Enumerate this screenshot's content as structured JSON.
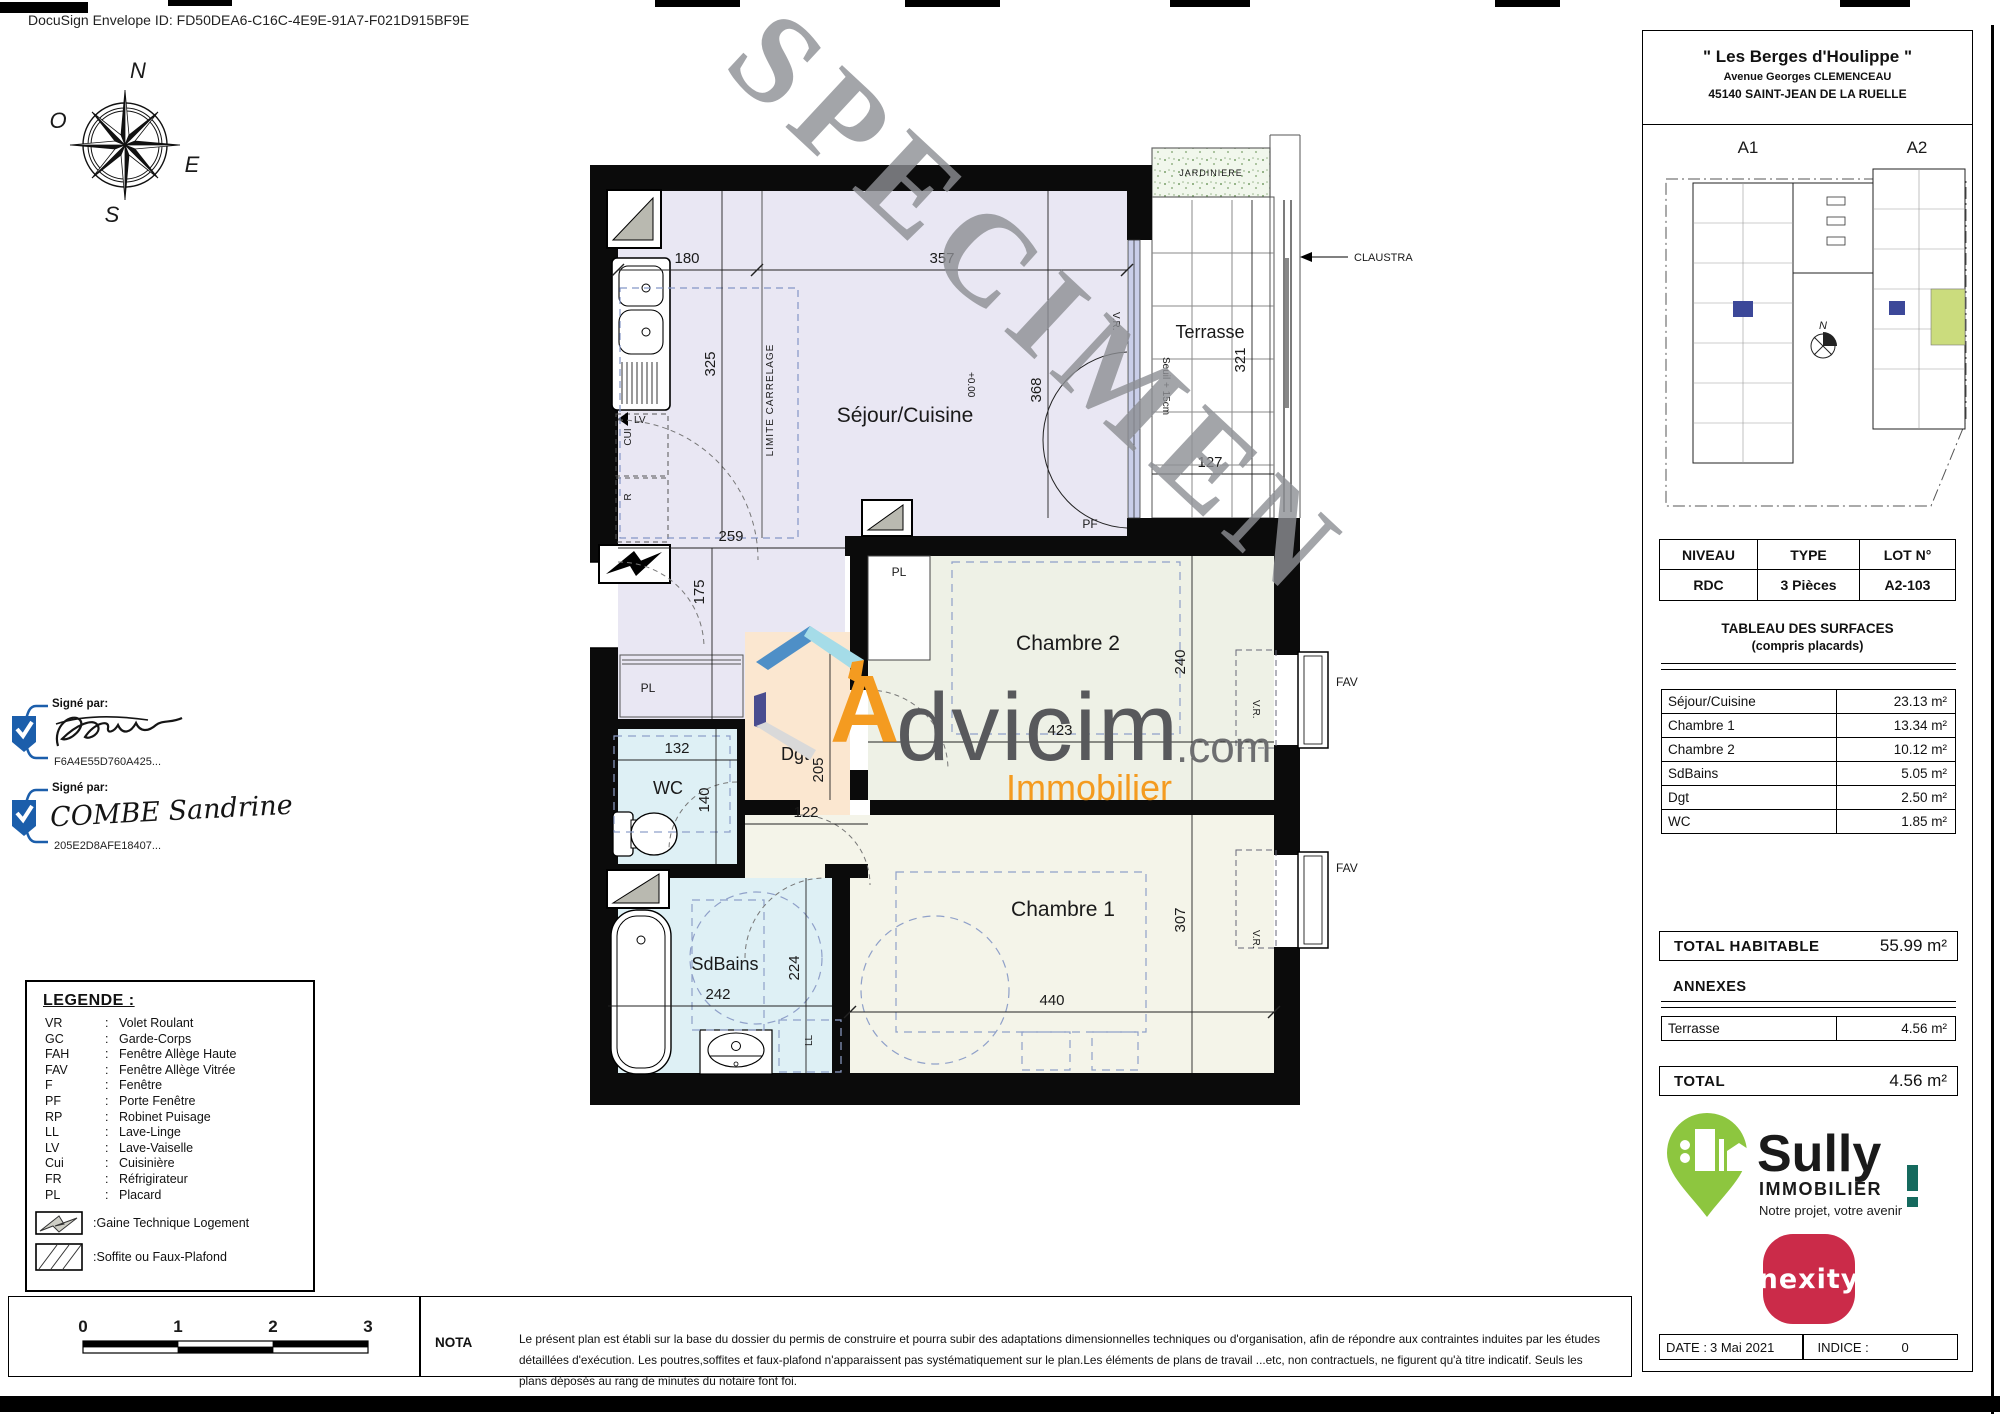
{
  "docusign": {
    "envelope": "DocuSign Envelope ID: FD50DEA6-C16C-4E9E-91A7-F021D915BF9E"
  },
  "watermark": "SPECIMEN",
  "compass": {
    "n": "N",
    "o": "O",
    "e": "E",
    "s": "S"
  },
  "advicim": {
    "initial": "A",
    "name": "dvicim",
    "tld": ".com",
    "tagline": "Immobilier"
  },
  "signatures": {
    "sig1": {
      "label": "Signé par:",
      "id": "F6A4E55D760A425..."
    },
    "sig2": {
      "label": "Signé par:",
      "name": "COMBE Sandrine",
      "id": "205E2D8AFE18407..."
    }
  },
  "plan": {
    "rooms": {
      "sejour": "Séjour/Cuisine",
      "chambre2": "Chambre 2",
      "chambre1": "Chambre 1",
      "sdbains": "SdBains",
      "wc": "WC",
      "dgt": "Dgt",
      "terrasse": "Terrasse"
    },
    "annotations": {
      "pl": "PL",
      "pf": "PF",
      "fav": "FAV",
      "vr": "V.R.",
      "claustra": "CLAUSTRA",
      "jardiniere": "JARDINIERE",
      "limite_carrelage": "LIMITE CARRELAGE",
      "cui": "CUI",
      "fridge": "R",
      "lv": "LV",
      "ll": "LL",
      "level": "+0.00",
      "seuil": "Seuil + 15cm"
    },
    "dims": {
      "d180": "180",
      "d357": "357",
      "d325": "325",
      "d368": "368",
      "d259": "259",
      "d175": "175",
      "d132": "132",
      "d140": "140",
      "d122": "122",
      "d205": "205",
      "d240": "240",
      "d423": "423",
      "d440": "440",
      "d307": "307",
      "d242": "242",
      "d224": "224",
      "d321": "321",
      "d127": "127"
    }
  },
  "legend": {
    "title": "LEGENDE :",
    "colon": ":",
    "items": [
      {
        "abbr": "VR",
        "label": "Volet Roulant"
      },
      {
        "abbr": "GC",
        "label": "Garde-Corps"
      },
      {
        "abbr": "FAH",
        "label": "Fenêtre Allège Haute"
      },
      {
        "abbr": "FAV",
        "label": "Fenêtre Allège Vitrée"
      },
      {
        "abbr": "F",
        "label": "Fenêtre"
      },
      {
        "abbr": "PF",
        "label": "Porte Fenêtre"
      },
      {
        "abbr": "RP",
        "label": "Robinet Puisage"
      },
      {
        "abbr": "LL",
        "label": "Lave-Linge"
      },
      {
        "abbr": "LV",
        "label": "Lave-Vaiselle"
      },
      {
        "abbr": "Cui",
        "label": "Cuisinière"
      },
      {
        "abbr": "FR",
        "label": "Réfrigirateur"
      },
      {
        "abbr": "PL",
        "label": "Placard"
      }
    ],
    "gtl": "Gaine Technique Logement",
    "soffite": "Soffite ou Faux-Plafond"
  },
  "scalebar": {
    "t0": "0",
    "t1": "1",
    "t2": "2",
    "t3": "3"
  },
  "nota": {
    "label": "NOTA",
    "text": "Le présent plan est établi sur la base du dossier du permis de construire et pourra subir des adaptations dimensionnelles techniques ou d'organisation, afin de répondre aux contraintes induites par les études détaillées d'exécution. Les poutres,soffites et faux-plafond n'apparaissent pas systématiquement sur le plan.Les éléments de plans de travail ...etc, non contractuels, ne figurent qu'à titre indicatif. Seuls les plans déposés au rang de minutes du notaire font foi."
  },
  "panel": {
    "title": "\" Les Berges d'Houlippe \"",
    "address1": "Avenue Georges CLEMENCEAU",
    "address2": "45140 SAINT-JEAN DE LA RUELLE",
    "siteplan": {
      "a1": "A1",
      "a2": "A2",
      "north": "N"
    },
    "level_table": {
      "h1": "NIVEAU",
      "h2": "TYPE",
      "h3": "LOT N°",
      "v1": "RDC",
      "v2": "3 Pièces",
      "v3": "A2-103"
    },
    "surfaces": {
      "title": "TABLEAU DES SURFACES",
      "subtitle": "(compris placards)",
      "rows": [
        [
          "Séjour/Cuisine",
          "23.13 m²"
        ],
        [
          "Chambre 1",
          "13.34 m²"
        ],
        [
          "Chambre 2",
          "10.12 m²"
        ],
        [
          "SdBains",
          "5.05 m²"
        ],
        [
          "Dgt",
          "2.50 m²"
        ],
        [
          "WC",
          "1.85 m²"
        ]
      ]
    },
    "total_habitable": {
      "label": "TOTAL HABITABLE",
      "value": "55.99 m²"
    },
    "annexes": {
      "label": "ANNEXES",
      "rows": [
        [
          "Terrasse",
          "4.56 m²"
        ]
      ]
    },
    "total": {
      "label": "TOTAL",
      "value": "4.56 m²"
    },
    "sully": {
      "name": "Sully",
      "sub": "IMMOBILIER",
      "tagline": "Notre projet, votre avenir"
    },
    "nexity": "nexity",
    "footer": {
      "date_label": "DATE :",
      "date": "3 Mai 2021",
      "indice_label": "INDICE :",
      "indice": "0"
    }
  },
  "colors": {
    "advicim_orange": "#F49B20",
    "advicim_gray": "#58595C",
    "sully_teal": "#156A5E",
    "sully_green": "#8DC63F",
    "nexity_red": "#CB2B49",
    "marker_red": "#D93A30",
    "docusign_blue": "#1B5EAB",
    "highlight_green": "#CBDC7D",
    "room_lavender": "#E9E7F3",
    "room_blue": "#DEF0F5",
    "room_peach": "#FBE7D0",
    "room_cream": "#F4F4E9",
    "room_green": "#EEF1E6",
    "watermark_gray": "#8D8F94"
  }
}
